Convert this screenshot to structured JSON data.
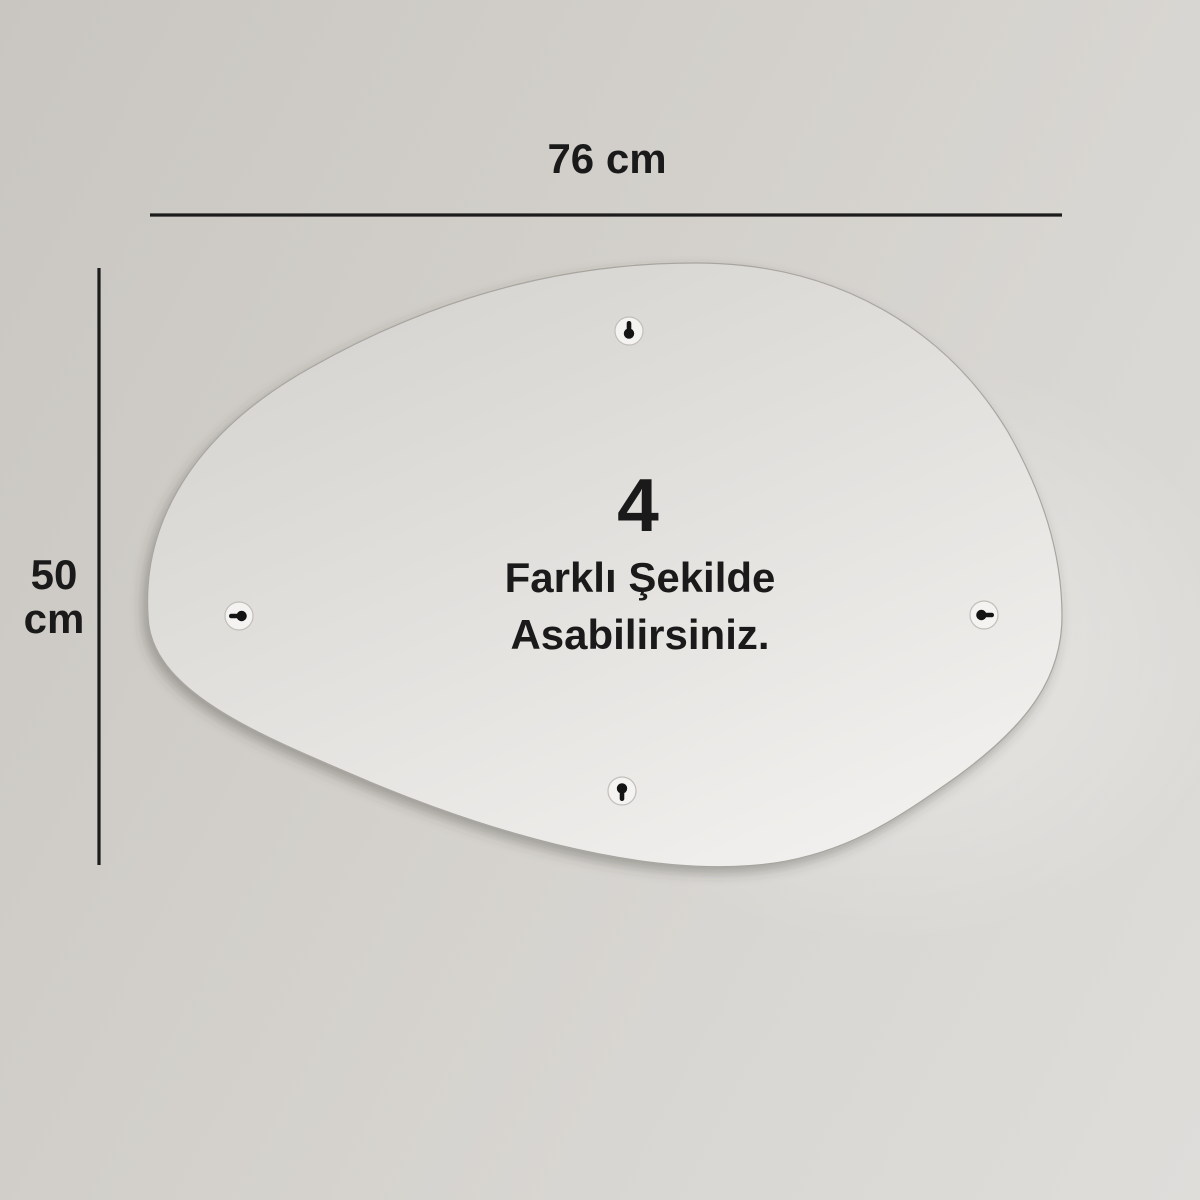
{
  "dimensions": {
    "width_label": "76 cm",
    "height_value": "50",
    "height_unit": "cm"
  },
  "panel": {
    "count": "4",
    "caption_line1": "Farklı Şekilde",
    "caption_line2": "Asabilirsiniz."
  },
  "icons": {
    "hangers": [
      {
        "name": "keyhole-top-icon",
        "position": "top"
      },
      {
        "name": "keyhole-left-icon",
        "position": "left"
      },
      {
        "name": "keyhole-right-icon",
        "position": "right"
      },
      {
        "name": "keyhole-bottom-icon",
        "position": "bottom"
      }
    ]
  },
  "colors": {
    "background": "#d3d0cb",
    "panel_dark": "#d7d5d1",
    "panel_light": "#f2f1ef",
    "ink": "#1a1a1a",
    "dimension_line": "#1c1c1c"
  }
}
